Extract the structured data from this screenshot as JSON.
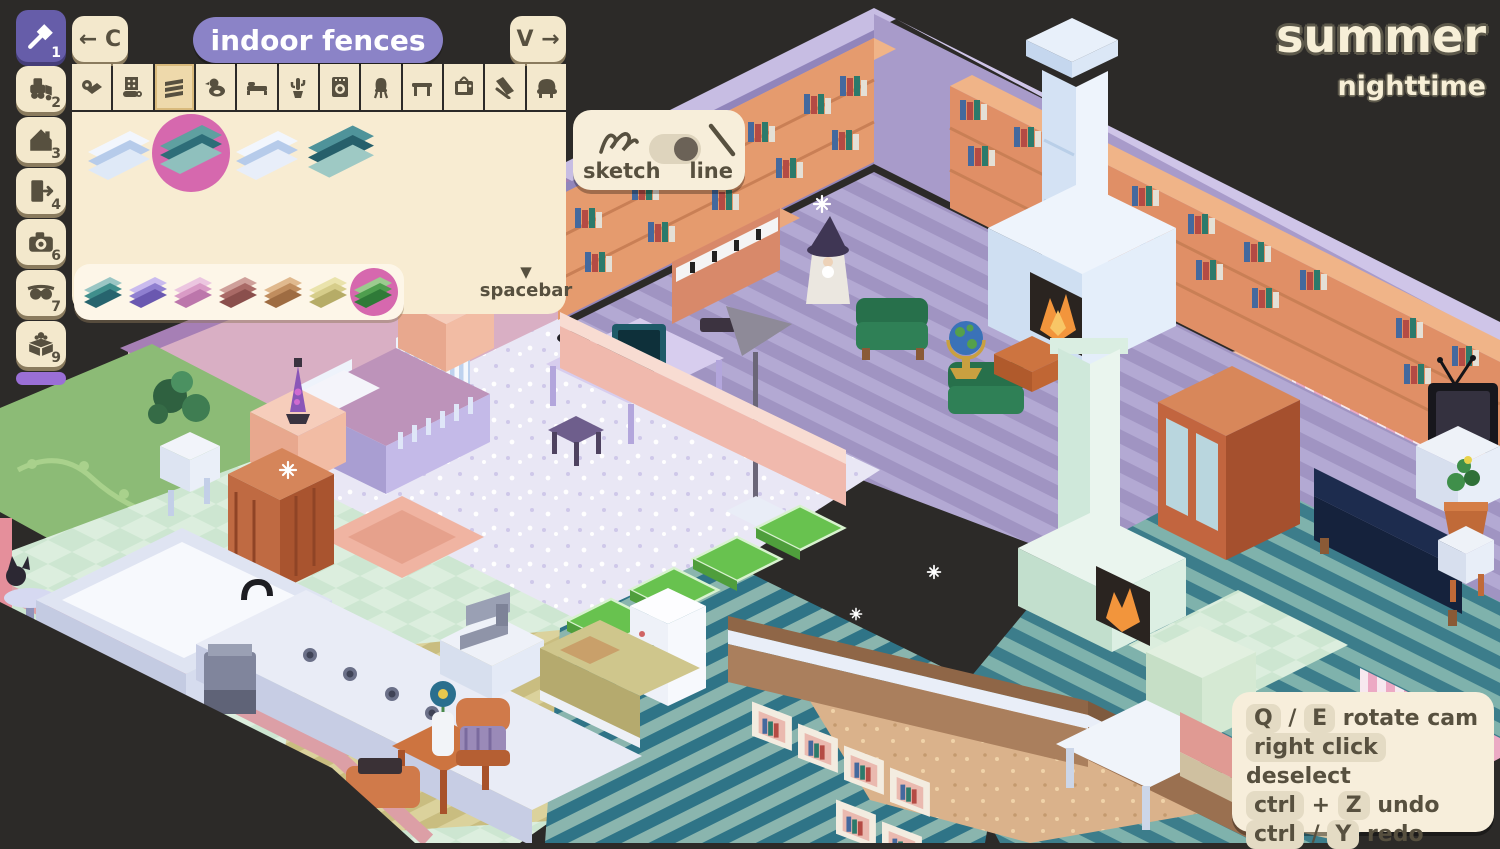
{
  "window": {
    "background": "#2c2a28"
  },
  "header": {
    "back_label": "← C",
    "title": "indoor fences",
    "forward_label": "V →"
  },
  "season_display": {
    "season": "summer",
    "time": "nighttime"
  },
  "toolbar": {
    "tools": [
      {
        "name": "build-hammer",
        "badge": "1",
        "selected": true
      },
      {
        "name": "bulldozer",
        "badge": "2",
        "selected": false
      },
      {
        "name": "house",
        "badge": "3",
        "selected": false
      },
      {
        "name": "exit-door",
        "badge": "4",
        "selected": false
      },
      {
        "name": "camera",
        "badge": "6",
        "selected": false
      },
      {
        "name": "sunglasses",
        "badge": "7",
        "selected": false
      },
      {
        "name": "decor-box",
        "badge": "9",
        "selected": false
      }
    ]
  },
  "categories": {
    "selected_index": 2,
    "items": [
      {
        "name": "rugs"
      },
      {
        "name": "wallpaper"
      },
      {
        "name": "indoor-fences"
      },
      {
        "name": "toys"
      },
      {
        "name": "beds"
      },
      {
        "name": "plants"
      },
      {
        "name": "appliances"
      },
      {
        "name": "chairs"
      },
      {
        "name": "tables"
      },
      {
        "name": "electronics"
      },
      {
        "name": "ramps"
      },
      {
        "name": "sofas"
      }
    ]
  },
  "items_panel": {
    "selected_index": 1,
    "selection_color": "#d668ae",
    "items": [
      {
        "name": "fence-light-blue",
        "bands": [
          "#f2f6fd",
          "#b6cbea",
          "#dfe9f7"
        ]
      },
      {
        "name": "fence-teal",
        "bands": [
          "#5fa0a0",
          "#2d6d78",
          "#8fc0bd"
        ]
      },
      {
        "name": "fence-light-blue-thin",
        "bands": [
          "#f2f6fd",
          "#b6cbea",
          "#e8eef9"
        ]
      },
      {
        "name": "fence-teal-large",
        "bands": [
          "#4f939a",
          "#265f6b",
          "#9ec9c4"
        ]
      }
    ]
  },
  "color_variants": {
    "selected_index": 6,
    "selection_color": "#d668ae",
    "colors": [
      {
        "name": "teal",
        "bands": [
          "#9ac6c4",
          "#3f8e8c",
          "#27646e"
        ]
      },
      {
        "name": "purple",
        "bands": [
          "#cabbee",
          "#8f7fd0",
          "#6a58b0"
        ]
      },
      {
        "name": "pink",
        "bands": [
          "#ecc6e0",
          "#d99bc6",
          "#bc76ab"
        ]
      },
      {
        "name": "maroon",
        "bands": [
          "#cfa09a",
          "#a96a66",
          "#8a4f4c"
        ]
      },
      {
        "name": "tan",
        "bands": [
          "#e0b98e",
          "#c08d5e",
          "#9e6c42"
        ]
      },
      {
        "name": "yellow",
        "bands": [
          "#eae3ac",
          "#d6cd8a",
          "#b6ac67"
        ]
      },
      {
        "name": "green",
        "bands": [
          "#9ccb8f",
          "#4e9e4e",
          "#2f7a38"
        ]
      }
    ]
  },
  "spacebar_hint": {
    "arrow": "▼",
    "label": "spacebar"
  },
  "draw_mode": {
    "sketch_label": "sketch",
    "line_label": "line",
    "active": "line"
  },
  "shortcuts": {
    "rows": [
      {
        "key1": "Q",
        "sep": "/",
        "key2": "E",
        "action": "rotate cam"
      },
      {
        "key1": "right click",
        "sep": "",
        "key2": "",
        "action": "deselect"
      },
      {
        "key1": "ctrl",
        "sep": "+",
        "key2": "Z",
        "action": "undo"
      },
      {
        "key1": "ctrl",
        "sep": "/",
        "key2": "Y",
        "action": "redo"
      }
    ]
  },
  "scene_palette": {
    "library_wall": "#a89bca",
    "library_floor_stripes": [
      "#b3a9d3",
      "#a094c2"
    ],
    "bookshelf": "#e59b6e",
    "fireplace": "#d4e2f4",
    "bedroom_floor": "#e9e7f5",
    "teal_floor": [
      "#7fb2ac",
      "#3c7d8b"
    ],
    "mint_floor": [
      "#dceede",
      "#cde6d1"
    ],
    "yellow_floor": [
      "#dbd29c",
      "#c9bd80"
    ],
    "selection_tiles": "#68c24f",
    "platform_edge": "#dc9fa6"
  }
}
